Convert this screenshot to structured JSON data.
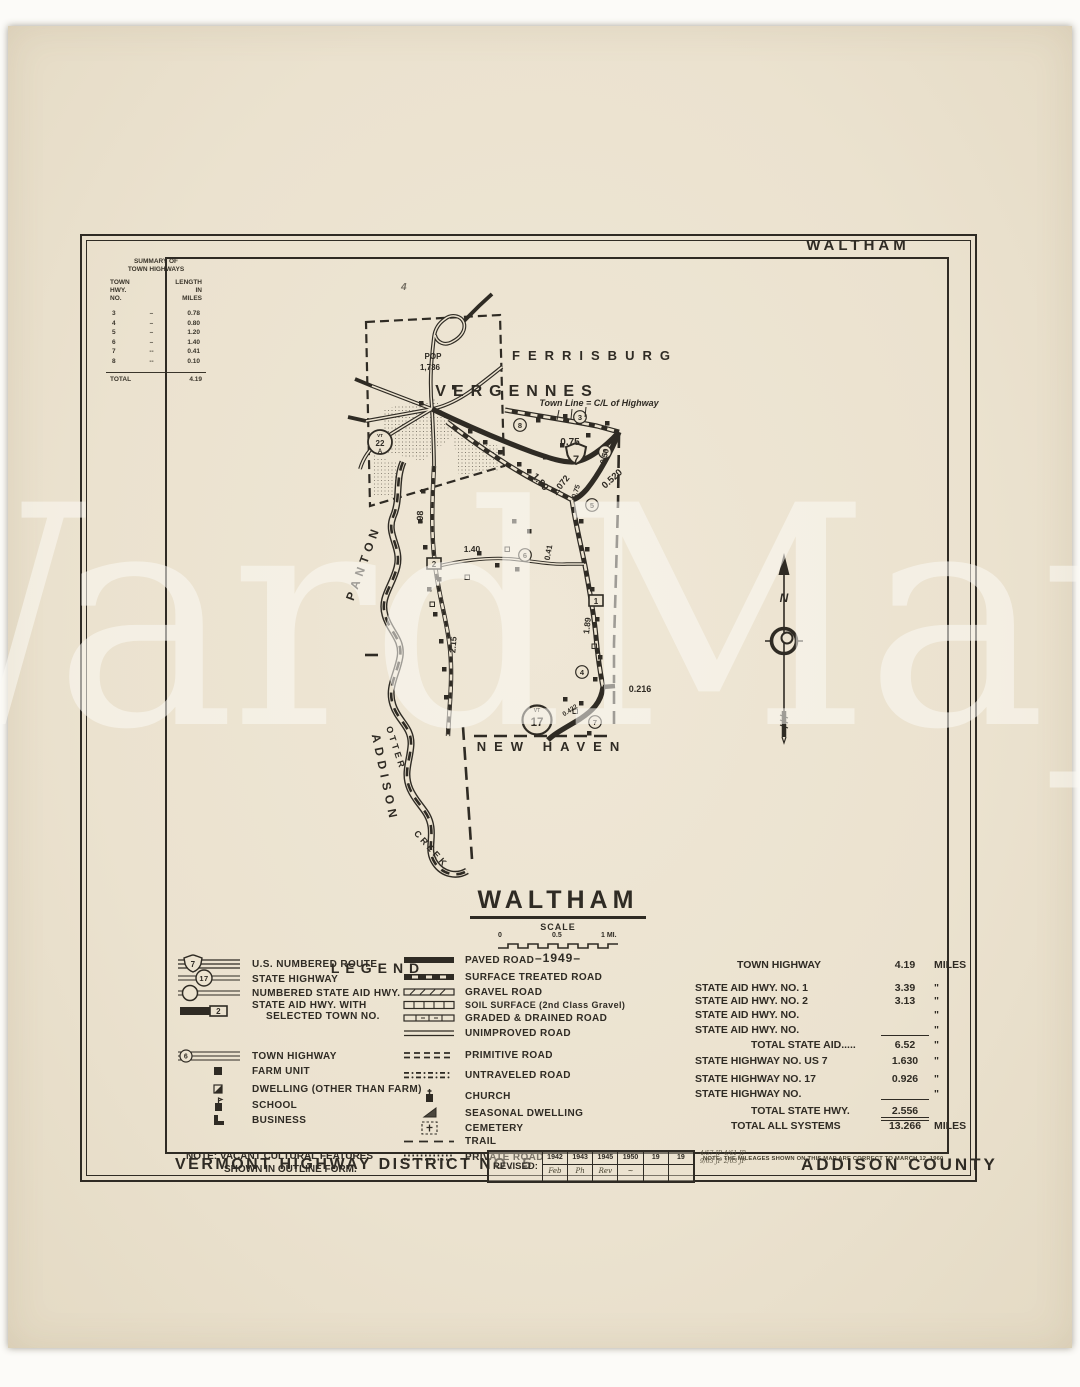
{
  "colors": {
    "paper": "#ece3d0",
    "ink": "#2f2b24"
  },
  "watermark": {
    "text": "WardMaps"
  },
  "header": {
    "corner_label": "WALTHAM"
  },
  "summary": {
    "title1": "SUMMARY OF",
    "title2": "TOWN HIGHWAYS",
    "col1_l1": "TOWN",
    "col1_l2": "HWY.",
    "col1_l3": "NO.",
    "col2_l1": "LENGTH",
    "col2_l2": "IN",
    "col2_l3": "MILES",
    "rows": [
      {
        "no": "3",
        "dash": "–",
        "len": "0.78"
      },
      {
        "no": "4",
        "dash": "–",
        "len": "0.80"
      },
      {
        "no": "5",
        "dash": "–",
        "len": "1.20"
      },
      {
        "no": "6",
        "dash": "–",
        "len": "1.40"
      },
      {
        "no": "7",
        "dash": "--",
        "len": "0.41"
      },
      {
        "no": "8",
        "dash": "--",
        "len": "0.10"
      }
    ],
    "total_label": "TOTAL",
    "total_value": "4.19"
  },
  "map": {
    "towns": {
      "ferrisburg": "FERRISBURG",
      "vergennes": "VERGENNES",
      "new_haven": "NEW HAVEN",
      "panton": "PANTON",
      "addison": "ADDISON"
    },
    "creek": {
      "word1": "OTTER",
      "word2": "CREEK"
    },
    "pop_label": "POP",
    "pop_value": "1,736",
    "town_line_note": "Town Line = C/L of Highway",
    "handwritten_mark": "4",
    "markers": {
      "us7": "7",
      "vt17_vt": "VT",
      "vt17": "17",
      "vt22a_vt": "VT",
      "vt22a": "22",
      "vt22a_suffix": "A",
      "sa1": "1",
      "sa2": "2"
    },
    "circles": {
      "c3": "3",
      "c4": "4",
      "c5a": "5",
      "c5b": "5",
      "c6": "6",
      "c7": "7",
      "c8": "8"
    },
    "miles": {
      "m075a": "0.75",
      "m1072": "1.072",
      "m050": "0.50",
      "m0520": "0.520",
      "m075b": "0.75",
      "m189a": "1.89",
      "m98": ".98",
      "m140": "1.40",
      "m041": "0.41",
      "m215": "2.15",
      "m189b": "1.89",
      "m0216": "0.216",
      "m0422": "0.422"
    },
    "north_letter": "N"
  },
  "title_block": {
    "title": "WALTHAM",
    "scale_label": "SCALE",
    "tick0": "0",
    "tick05": "0.5",
    "tick1": "1 MI.",
    "year": "–1949–"
  },
  "legend": {
    "title": "LEGEND",
    "left": [
      {
        "label": "U.S. NUMBERED ROUTE"
      },
      {
        "label": "STATE HIGHWAY"
      },
      {
        "label": "NUMBERED STATE AID HWY."
      },
      {
        "label": "STATE AID HWY. WITH",
        "label2": "SELECTED TOWN NO."
      },
      {
        "label": "TOWN HIGHWAY"
      },
      {
        "label": "FARM UNIT"
      },
      {
        "label": "DWELLING (OTHER THAN FARM)"
      },
      {
        "label": "SCHOOL"
      },
      {
        "label": "BUSINESS"
      }
    ],
    "right": [
      "PAVED ROAD",
      "SURFACE TREATED ROAD",
      "GRAVEL ROAD",
      "SOIL SURFACE (2nd Class Gravel)",
      "GRADED & DRAINED ROAD",
      "UNIMPROVED ROAD",
      "PRIMITIVE ROAD",
      "UNTRAVELED ROAD",
      "CHURCH",
      "SEASONAL DWELLING",
      "CEMETERY",
      "TRAIL",
      "PRIVATE ROAD"
    ],
    "sym": {
      "us": "7",
      "state": "17",
      "sa_box": "2",
      "town": "6"
    },
    "note1": "NOTE: VACANT CULTURAL FEATURES",
    "note2": "SHOWN IN OUTLINE FORM."
  },
  "mileage": {
    "rows": [
      {
        "label": "TOWN HIGHWAY",
        "value": "4.19",
        "unit": "MILES"
      },
      {
        "label": "STATE AID HWY. NO. 1",
        "value": "3.39",
        "unit": "\""
      },
      {
        "label": "STATE AID HWY. NO. 2",
        "value": "3.13",
        "unit": "\""
      },
      {
        "label": "STATE AID HWY. NO.",
        "value": "",
        "unit": "\""
      },
      {
        "label": "STATE AID HWY. NO.",
        "value": "",
        "unit": "\""
      },
      {
        "label": "TOTAL STATE AID.....",
        "value": "6.52",
        "unit": "\""
      },
      {
        "label": "STATE HIGHWAY NO. US 7",
        "value": "1.630",
        "unit": "\""
      },
      {
        "label": "STATE HIGHWAY NO. 17",
        "value": "0.926",
        "unit": "\""
      },
      {
        "label": "STATE HIGHWAY NO.",
        "value": "",
        "unit": "\""
      },
      {
        "label": "TOTAL STATE HWY.",
        "value": "2.556",
        "unit": ""
      },
      {
        "label": "TOTAL ALL SYSTEMS",
        "value": "13.266",
        "unit": "MILES"
      }
    ],
    "note": "NOTE: THE MILEAGES SHOWN ON THIS MAP ARE CORRECT TO MARCH 12, 1960"
  },
  "footer": {
    "district": "VERMONT HIGHWAY DISTRICT NO. 5",
    "revised_label": "REVISED:",
    "years": [
      "1942",
      "1943",
      "1945",
      "1950",
      "19",
      "19"
    ],
    "marks": [
      "Feb",
      "Ph",
      "Rev",
      "~",
      "",
      ""
    ],
    "scribble1": "4/57 JP   4/61 JP",
    "scribble2": "9/63 JP   2/63 JP",
    "county": "ADDISON COUNTY"
  }
}
